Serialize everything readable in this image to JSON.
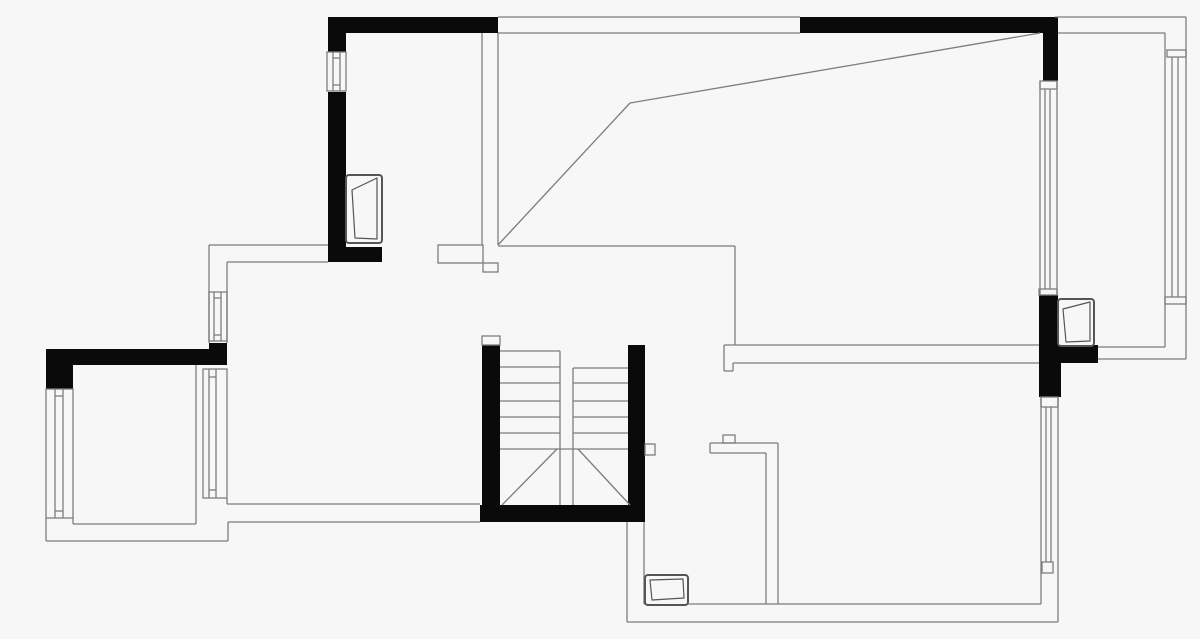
{
  "plan": {
    "title": "apartment-floor-plan",
    "canvas": {
      "width": 1200,
      "height": 639,
      "bg": "#f7f7f7"
    },
    "colors": {
      "wall_fill": "#0a0a0a",
      "line": "#7d7d7d",
      "line_dark": "#555555",
      "box_fill": "#f7f7f7"
    },
    "stroke_width": 1.3,
    "wall_rects": [
      [
        328,
        17,
        170,
        16
      ],
      [
        328,
        33,
        18,
        19
      ],
      [
        328,
        92,
        18,
        155
      ],
      [
        328,
        247,
        54,
        15
      ],
      [
        800,
        17,
        255,
        16
      ],
      [
        1043,
        17,
        15,
        64
      ],
      [
        1039,
        295,
        19,
        50
      ],
      [
        1039,
        345,
        59,
        18
      ],
      [
        1039,
        363,
        22,
        34
      ],
      [
        482,
        345,
        18,
        160
      ],
      [
        480,
        505,
        165,
        17
      ],
      [
        628,
        345,
        17,
        160
      ],
      [
        46,
        349,
        181,
        16
      ],
      [
        209,
        343,
        18,
        6
      ],
      [
        46,
        365,
        27,
        24
      ]
    ],
    "boxes": [
      [
        438,
        245,
        45,
        18
      ],
      [
        483,
        263,
        15,
        9
      ],
      [
        482,
        336,
        18,
        9
      ],
      [
        645,
        444,
        10,
        11
      ],
      [
        723,
        435,
        12,
        8
      ],
      [
        327,
        52,
        19,
        39
      ],
      [
        209,
        292,
        18,
        49
      ],
      [
        46,
        389,
        27,
        129
      ],
      [
        203,
        369,
        24,
        129
      ],
      [
        1040,
        81,
        17,
        8
      ],
      [
        1039,
        289,
        18,
        6
      ],
      [
        1041,
        397,
        17,
        10
      ],
      [
        1042,
        562,
        11,
        11
      ],
      [
        1167,
        50,
        19,
        7
      ],
      [
        1165,
        297,
        21,
        7
      ]
    ],
    "lines": [
      [
        498,
        17,
        800,
        17
      ],
      [
        498,
        33,
        800,
        33
      ],
      [
        1055,
        17,
        1186,
        17
      ],
      [
        1058,
        33,
        1165,
        33
      ],
      [
        1186,
        17,
        1186,
        359
      ],
      [
        1165,
        33,
        1165,
        347
      ],
      [
        482,
        33,
        482,
        245
      ],
      [
        498,
        33,
        498,
        245
      ],
      [
        498,
        245,
        630,
        103
      ],
      [
        630,
        103,
        1040,
        33
      ],
      [
        498,
        246,
        735,
        246
      ],
      [
        735,
        246,
        735,
        345
      ],
      [
        209,
        245,
        328,
        245
      ],
      [
        227,
        262,
        328,
        262
      ],
      [
        209,
        245,
        209,
        343
      ],
      [
        227,
        262,
        227,
        343
      ],
      [
        46,
        518,
        46,
        541
      ],
      [
        46,
        541,
        228,
        541
      ],
      [
        228,
        522,
        228,
        541
      ],
      [
        228,
        522,
        480,
        522
      ],
      [
        227,
        504,
        480,
        504
      ],
      [
        227,
        498,
        227,
        504
      ],
      [
        196,
        365,
        196,
        524
      ],
      [
        73,
        524,
        196,
        524
      ],
      [
        73,
        518,
        73,
        524
      ],
      [
        500,
        351,
        560,
        351
      ],
      [
        500,
        367,
        560,
        367
      ],
      [
        500,
        383,
        560,
        383
      ],
      [
        500,
        401,
        560,
        401
      ],
      [
        500,
        417,
        560,
        417
      ],
      [
        500,
        433,
        560,
        433
      ],
      [
        500,
        449,
        628,
        449
      ],
      [
        573,
        368,
        628,
        368
      ],
      [
        573,
        383,
        628,
        383
      ],
      [
        573,
        401,
        628,
        401
      ],
      [
        573,
        417,
        628,
        417
      ],
      [
        573,
        433,
        628,
        433
      ],
      [
        560,
        351,
        560,
        505
      ],
      [
        573,
        368,
        573,
        505
      ],
      [
        502,
        505,
        557,
        449
      ],
      [
        578,
        449,
        630,
        505
      ],
      [
        627,
        522,
        627,
        622
      ],
      [
        644,
        522,
        644,
        604
      ],
      [
        644,
        604,
        1041,
        604
      ],
      [
        627,
        622,
        1058,
        622
      ],
      [
        766,
        453,
        766,
        604
      ],
      [
        778,
        443,
        778,
        604
      ],
      [
        710,
        443,
        778,
        443
      ],
      [
        710,
        453,
        766,
        453
      ],
      [
        710,
        443,
        710,
        453
      ],
      [
        1041,
        397,
        1041,
        604
      ],
      [
        1058,
        397,
        1058,
        622
      ],
      [
        724,
        345,
        1039,
        345
      ],
      [
        733,
        363,
        1039,
        363
      ],
      [
        724,
        345,
        724,
        371
      ],
      [
        724,
        371,
        733,
        371
      ],
      [
        733,
        363,
        733,
        371
      ],
      [
        1098,
        347,
        1165,
        347
      ],
      [
        1098,
        359,
        1186,
        359
      ],
      [
        1040,
        81,
        1040,
        295
      ],
      [
        1057,
        81,
        1057,
        295
      ],
      [
        333,
        52,
        333,
        91
      ],
      [
        340,
        52,
        340,
        91
      ],
      [
        333,
        58,
        340,
        58
      ],
      [
        333,
        85,
        340,
        85
      ],
      [
        214,
        292,
        214,
        341
      ],
      [
        221,
        292,
        221,
        341
      ],
      [
        214,
        298,
        221,
        298
      ],
      [
        214,
        335,
        221,
        335
      ],
      [
        55,
        389,
        55,
        518
      ],
      [
        63,
        389,
        63,
        518
      ],
      [
        55,
        396,
        63,
        396
      ],
      [
        55,
        511,
        63,
        511
      ],
      [
        209,
        369,
        209,
        498
      ],
      [
        216,
        369,
        216,
        498
      ],
      [
        209,
        377,
        216,
        377
      ],
      [
        209,
        490,
        216,
        490
      ],
      [
        1045,
        89,
        1045,
        289
      ],
      [
        1050,
        89,
        1050,
        289
      ],
      [
        1046,
        407,
        1046,
        562
      ],
      [
        1051,
        407,
        1051,
        562
      ],
      [
        1172,
        57,
        1172,
        297
      ],
      [
        1178,
        57,
        1178,
        297
      ]
    ],
    "door_panels": [
      {
        "rect": [
          346,
          175,
          36,
          68
        ],
        "fold": [
          [
            352,
            190
          ],
          [
            377,
            178
          ],
          [
            377,
            239
          ],
          [
            355,
            238
          ]
        ]
      },
      {
        "rect": [
          1058,
          299,
          36,
          47
        ],
        "fold": [
          [
            1063,
            309
          ],
          [
            1090,
            302
          ],
          [
            1090,
            341
          ],
          [
            1066,
            342
          ]
        ]
      },
      {
        "rect": [
          645,
          575,
          43,
          30
        ],
        "fold": [
          [
            650,
            580
          ],
          [
            683,
            579
          ],
          [
            684,
            598
          ],
          [
            652,
            600
          ]
        ]
      }
    ]
  }
}
